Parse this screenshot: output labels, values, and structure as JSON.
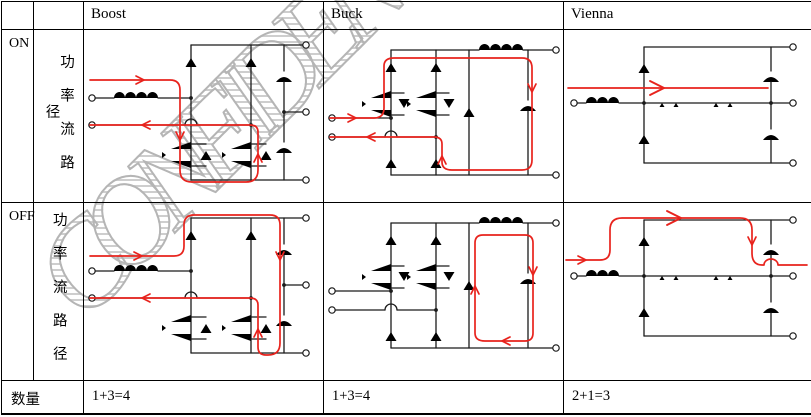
{
  "watermark": {
    "text": "CONFIDENTIAL"
  },
  "table": {
    "columns": [
      {
        "label": ""
      },
      {
        "label": ""
      },
      {
        "label": "Boost"
      },
      {
        "label": "Buck"
      },
      {
        "label": "Vienna"
      }
    ],
    "rows": [
      {
        "state": "ON",
        "metric": "功率流路径"
      },
      {
        "state": "OFF",
        "metric": "功率流路径"
      }
    ],
    "footer": {
      "label": "数量",
      "boost": "1+3=4",
      "buck": "1+3=4",
      "vienna": "2+1=3"
    }
  },
  "colors": {
    "flow_path_red": "#e8231d",
    "wire_black": "#1b1b1b",
    "wire_gray": "#8a8a8a",
    "watermark_gray": "#b5b5b5",
    "border_black": "#000000"
  }
}
